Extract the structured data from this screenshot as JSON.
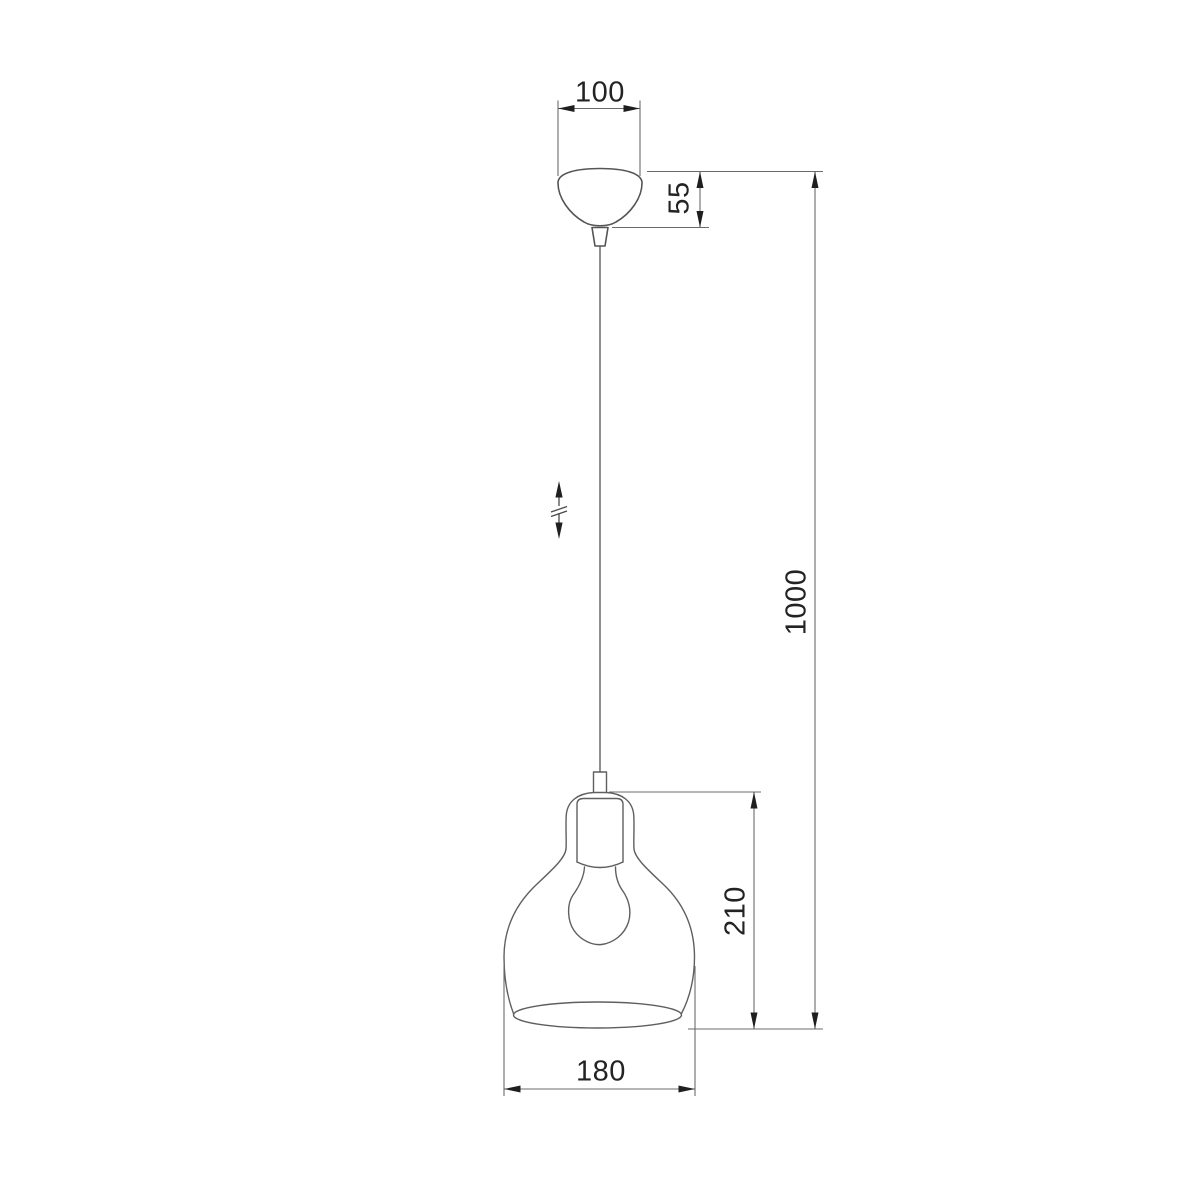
{
  "drawing": {
    "title": "pendant-lamp-dimension-drawing",
    "dimensions": {
      "canopy_width": "100",
      "canopy_height": "55",
      "suspension_drop": "1000",
      "shade_height": "210",
      "shade_diameter": "180"
    },
    "icons": {
      "height_adjustable": "double-arrow-with-break"
    },
    "colors": {
      "background": "#ffffff",
      "object_line": "#555555",
      "dimension_line": "#6b6b6b",
      "text": "#232323",
      "arrowhead": "#1f1f1f"
    }
  }
}
